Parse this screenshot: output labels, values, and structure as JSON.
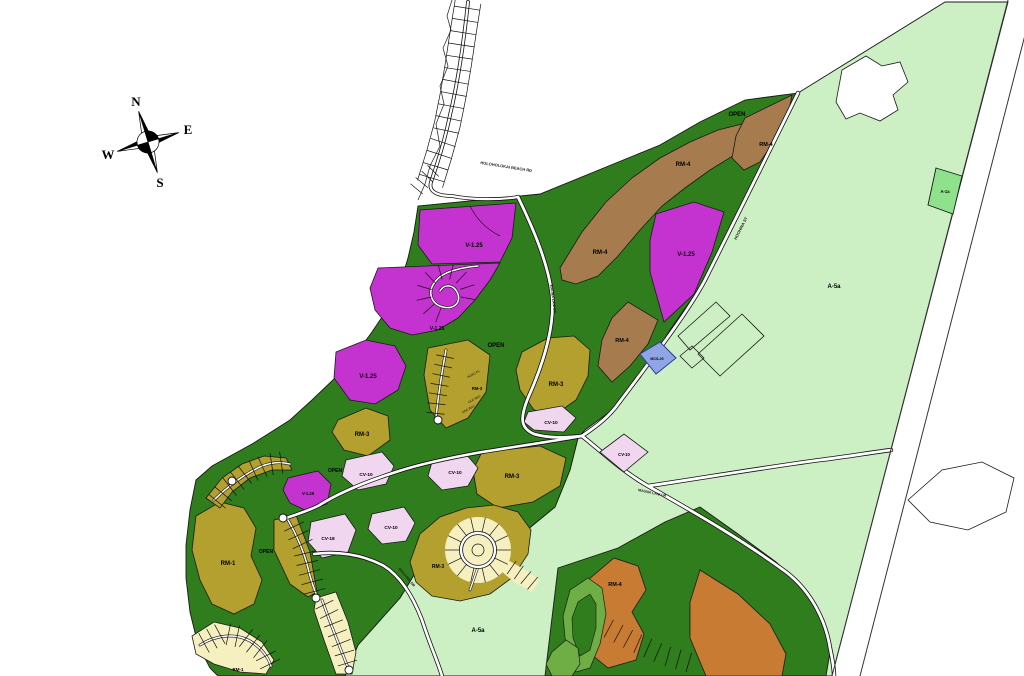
{
  "map": {
    "compass": {
      "north": "N",
      "east": "E",
      "south": "S",
      "west": "W"
    },
    "roads": {
      "beach_rd": "HOLOHOLOKAI BEACH RD",
      "hoohina_st": "HOOHINA ST",
      "mauna_lani_dr_upper": "MAUNA LANI DR",
      "mauna_lani_dr_lower": "MAUNA LANI DR",
      "south_rd": "MAKAIWA DR"
    },
    "streets": {
      "s1": "HOKU PL",
      "s2": "OLE WAY",
      "s3": "ANA WAY"
    },
    "zones": {
      "open_tr": "OPEN",
      "rm4_right": "RM-4",
      "rm4_center": "RM-4",
      "rm4_left": "RM-4",
      "rm4_road": "RM-4",
      "v125_tr": "V-1.25",
      "a1a": "A-1a",
      "a5a_main": "A-5a",
      "mcs20": "MCS-20",
      "v125_top": "V-1.25",
      "v125_sub": "V-1.25",
      "open_mid": "OPEN",
      "rm3_streets": "RM-3",
      "rm3_right": "RM-3",
      "cv10_a": "CV-10",
      "cv10_b": "CV-10",
      "rm3_big": "RM-3",
      "rm3_left": "RM-3",
      "v125_left": "V-1.25",
      "open_left": "OPEN",
      "cv10_c": "CV-10",
      "v125_bl": "V-1.25",
      "cv18": "CV-18",
      "cv10_d": "CV-10",
      "cv10_e": "CV-10",
      "rm1": "RM-1",
      "open_bl": "OPEN",
      "rm4_br": "RM-4",
      "a5a_bottom": "A-5a",
      "rm3_bottom": "RM-3",
      "rm1_b": "RM-1"
    },
    "colors": {
      "open_green": "#2f7d1d",
      "agriculture_light_green": "#ccefc4",
      "rm4_brown": "#a67c4f",
      "v125_magenta": "#c433cf",
      "rm_olive": "#b3a02e",
      "cv_pink": "#f1d6ef",
      "mcs_blue": "#8fa5e5",
      "rm4_orange": "#c87c33",
      "lots_cream": "#f6efc0"
    }
  }
}
